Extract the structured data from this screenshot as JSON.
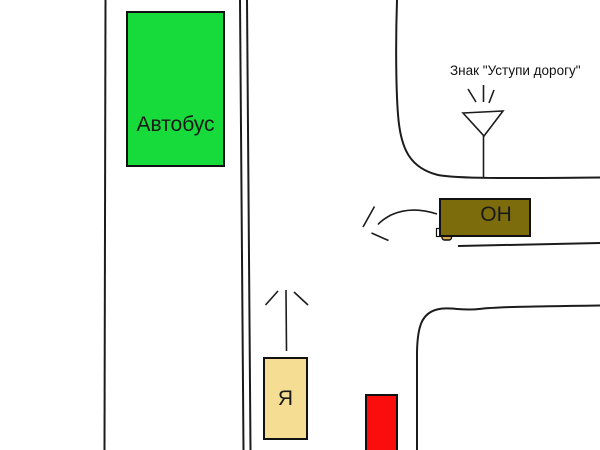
{
  "diagram": {
    "kind": "hand-drawn traffic intersection scheme",
    "labels": {
      "bus": "Автобус",
      "me": "Я",
      "him": "ОН",
      "sign": "Знак \"Уступи дорогу\""
    },
    "colors": {
      "background": "#FFFFFF",
      "bus_fill": "#17DA3B",
      "me_fill": "#F6DD94",
      "him_fill": "#7D6C0C",
      "red_fill": "#F90D0D",
      "line": "#1C1C1C",
      "box_border": "#111111",
      "artifact_fill": "#D9A94F",
      "artifact_white": "#FFFFFF"
    },
    "icons": {
      "yield_sign": "yield-sign-triangle-icon",
      "me_arrow": "up-arrow-icon",
      "him_arrow": "left-turn-arrow-icon",
      "artifact": "paint-bucket-cursor-artifact"
    }
  }
}
